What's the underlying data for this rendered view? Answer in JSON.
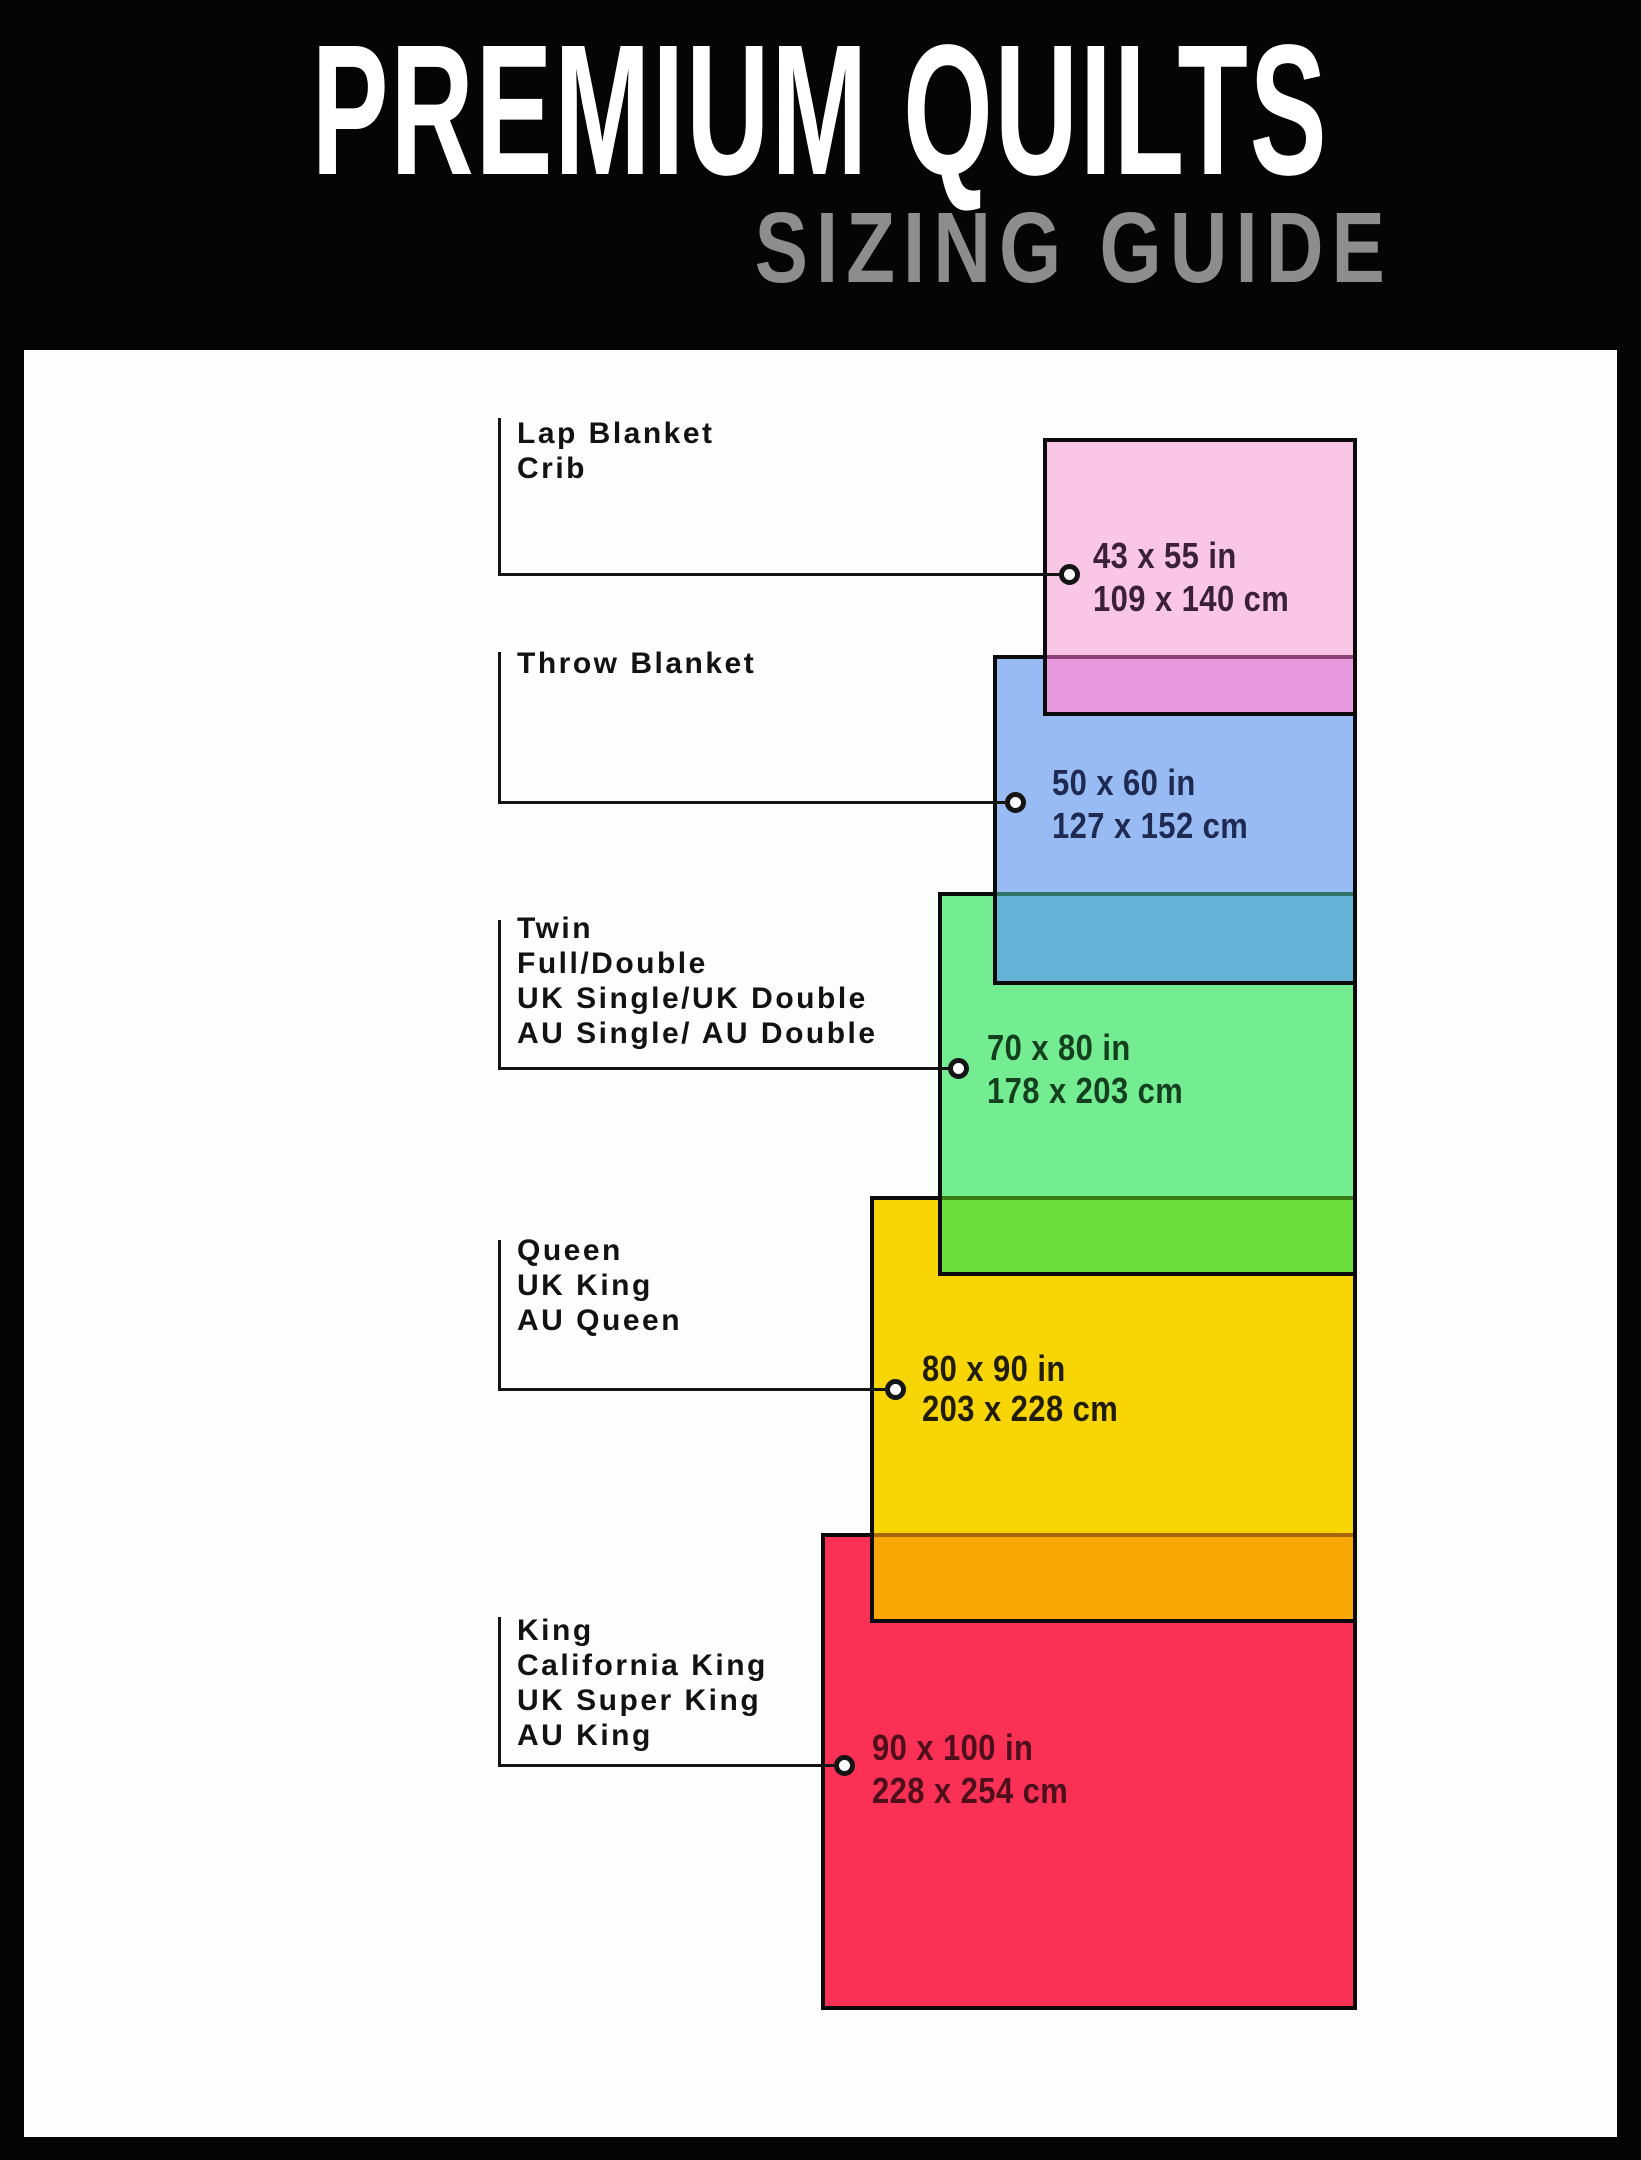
{
  "header": {
    "title": "PREMIUM QUILTS",
    "subtitle": "SIZING GUIDE"
  },
  "sizes": [
    {
      "labels": [
        "Lap Blanket",
        "Crib"
      ],
      "inches": "43 x 55 in",
      "cm": "109 x 140 cm",
      "fill_color": "#f9c6e6",
      "overlap_color": "#e89adf",
      "text_color": "#3a2138"
    },
    {
      "labels": [
        "Throw Blanket"
      ],
      "inches": "50 x 60 in",
      "cm": "127 x 152 cm",
      "fill_color": "#97bbf2",
      "overlap_color": "#64b2d6",
      "text_color": "#1e2a52"
    },
    {
      "labels": [
        "Twin",
        "Full/Double",
        "UK Single/UK Double",
        "AU Single/ AU Double"
      ],
      "inches": "70 x 80 in",
      "cm": "178 x 203 cm",
      "fill_color": "#74ed92",
      "overlap_color": "#6cdf3e",
      "text_color": "#14401f"
    },
    {
      "labels": [
        "Queen",
        "UK King",
        "AU Queen"
      ],
      "inches": "80 x 90 in",
      "cm": "203 x 228 cm",
      "fill_color": "#f8d605",
      "overlap_color": "#f8a705",
      "text_color": "#211c04"
    },
    {
      "labels": [
        "King",
        "California King",
        "UK Super King",
        "AU King"
      ],
      "inches": "90 x 100 in",
      "cm": "228 x 254 cm",
      "fill_color": "#fa3054",
      "text_color": "#4d0f1b"
    }
  ]
}
